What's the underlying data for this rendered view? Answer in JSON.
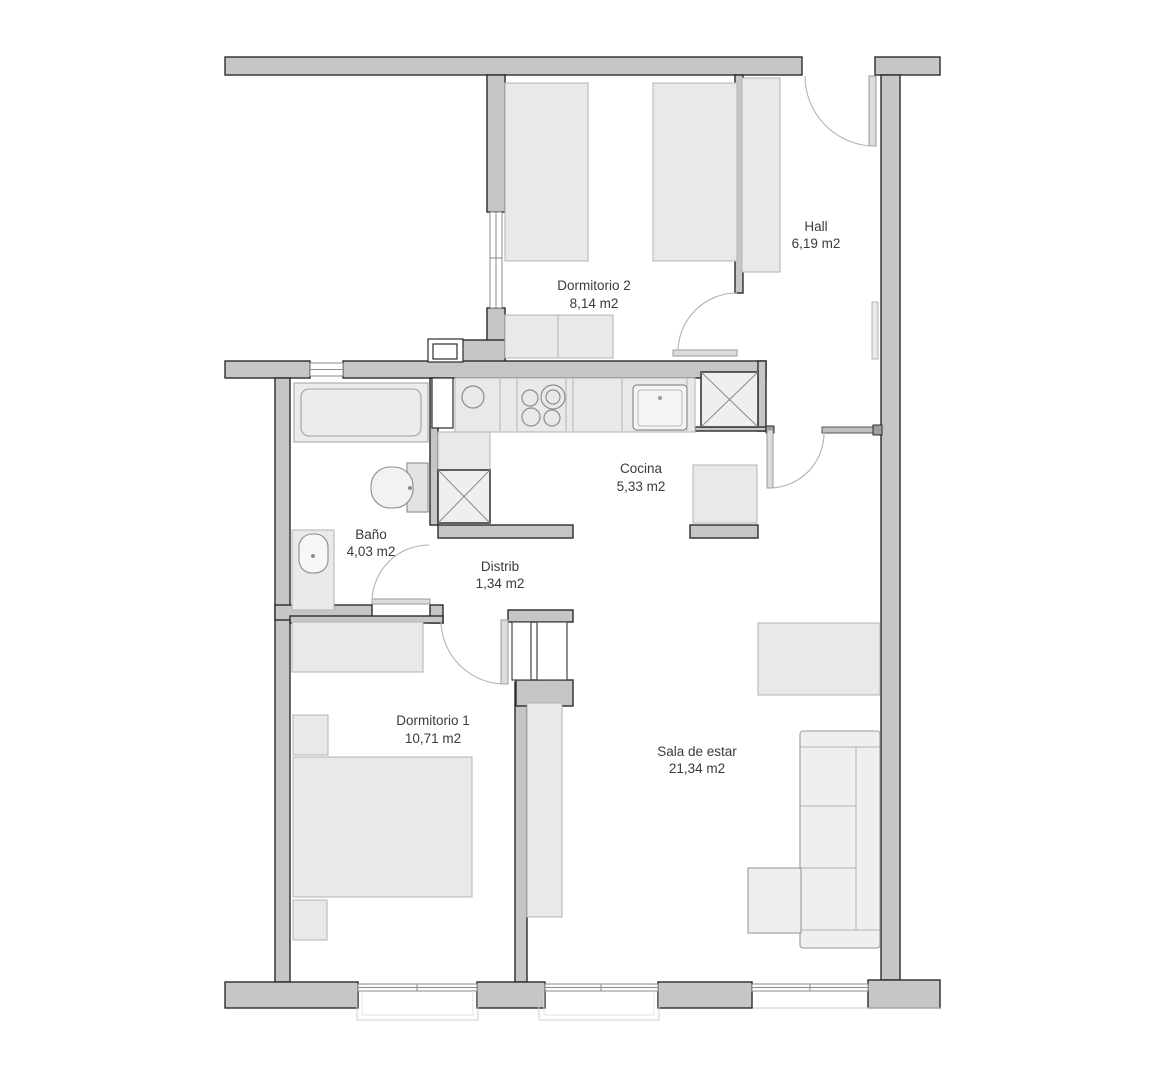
{
  "plan": {
    "type": "apartment-floor-plan",
    "units": "m2"
  },
  "rooms": {
    "hall": {
      "name": "Hall",
      "area": "6,19 m2"
    },
    "dormitorio2": {
      "name": "Dormitorio 2",
      "area": "8,14 m2"
    },
    "cocina": {
      "name": "Cocina",
      "area": "5,33 m2"
    },
    "bano": {
      "name": "Baño",
      "area": "4,03 m2"
    },
    "distrib": {
      "name": "Distrib",
      "area": "1,34 m2"
    },
    "dormitorio1": {
      "name": "Dormitorio 1",
      "area": "10,71 m2"
    },
    "sala": {
      "name": "Sala de estar",
      "area": "21,34 m2"
    }
  },
  "colors": {
    "background": "#ffffff",
    "wall_fill": "#c6c6c6",
    "wall_stroke": "#2b2b2b",
    "furniture_fill": "#e9e9e9",
    "furniture_stroke": "#b3b3b3",
    "fixture_stroke": "#8d8d8d",
    "door_arc": "#b3b3b3",
    "window_stroke": "#8a8a8a",
    "label_text": "#3b3b3b"
  }
}
